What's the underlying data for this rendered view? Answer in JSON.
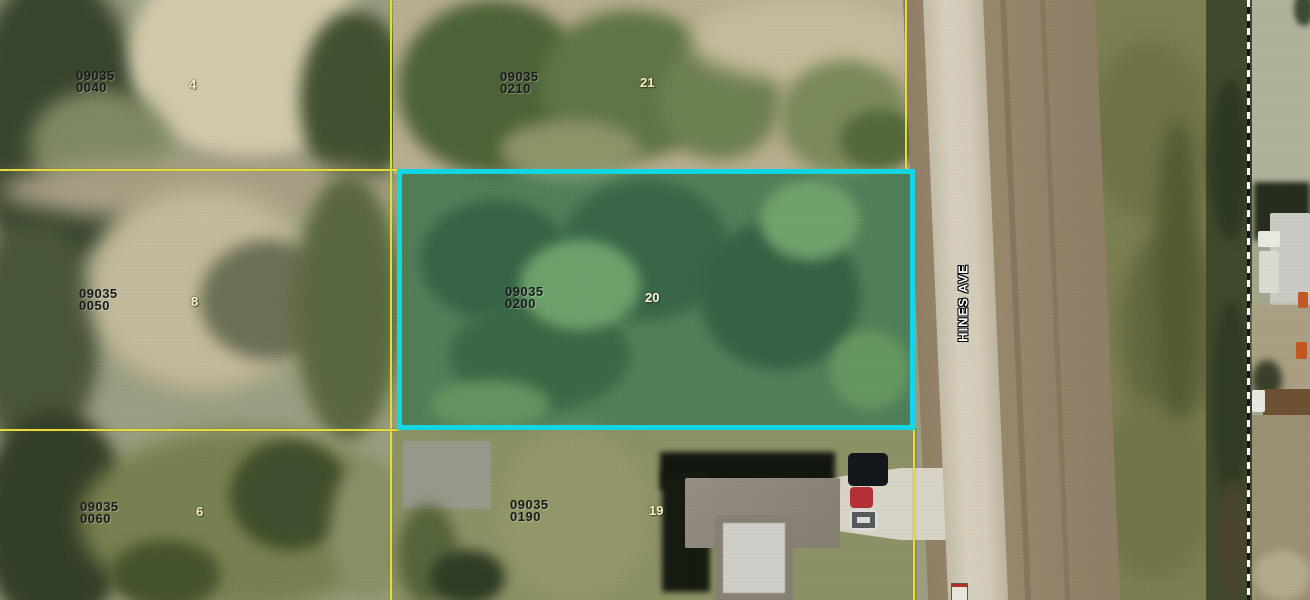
{
  "map": {
    "street": {
      "name": "HINES AVE"
    },
    "colors": {
      "selected_parcel_outline": "#12d7e6",
      "parcel_boundary_line": "#e9dc3a",
      "survey_line": "#ffffff"
    },
    "parcels": [
      {
        "apn_line1": "09035",
        "apn_line2": "0040",
        "lot": "4",
        "selected": false
      },
      {
        "apn_line1": "09035",
        "apn_line2": "0210",
        "lot": "21",
        "selected": false
      },
      {
        "apn_line1": "09035",
        "apn_line2": "0050",
        "lot": "8",
        "selected": false
      },
      {
        "apn_line1": "09035",
        "apn_line2": "0200",
        "lot": "20",
        "selected": true
      },
      {
        "apn_line1": "09035",
        "apn_line2": "0060",
        "lot": "6",
        "selected": false
      },
      {
        "apn_line1": "09035",
        "apn_line2": "0190",
        "lot": "19",
        "selected": false
      }
    ]
  }
}
